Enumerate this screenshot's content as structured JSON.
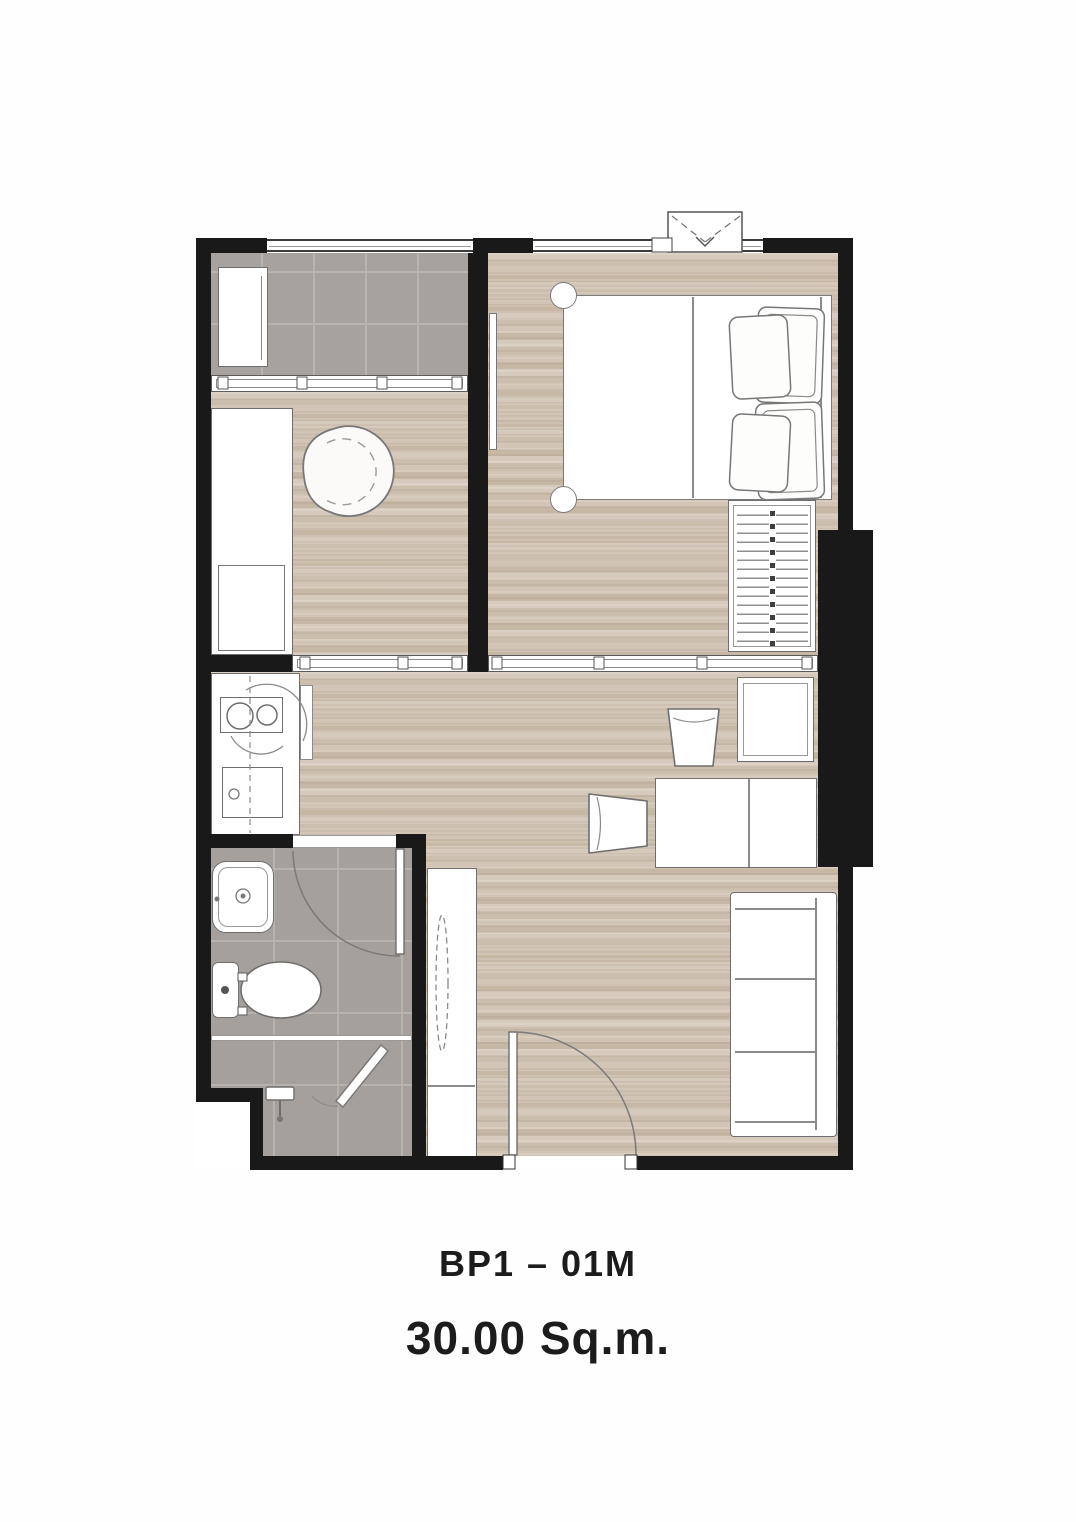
{
  "caption": {
    "unit_label": "BP1 – 01M",
    "area_label": "30.00 Sq.m."
  },
  "colors": {
    "wall": "#191919",
    "wood_floor": "#cfc1b0",
    "tile_floor": "#a7a29d",
    "tile_grid": "#b8b4af",
    "outline": "#6e6e6e",
    "background": "#ffffff",
    "text": "#1c1c1c"
  },
  "rooms": [
    "balcony",
    "multipurpose-room",
    "bedroom",
    "kitchen",
    "living-dining",
    "bathroom",
    "shower",
    "entry"
  ],
  "furniture_icons": [
    "ac-unit-icon",
    "counter-icon",
    "washing-machine-icon",
    "lounge-chair-icon",
    "mirror-icon",
    "double-bed-icon",
    "pillow-icon",
    "wardrobe-hangers-icon",
    "two-burner-stove-icon",
    "kitchen-sink-icon",
    "dining-table-icon",
    "dining-chair-icon",
    "wall-cabinet-icon",
    "sofa-icon",
    "entry-cabinet-icon",
    "tall-mirror-icon",
    "bathroom-sink-icon",
    "toilet-icon",
    "shower-head-icon",
    "shower-screen-icon",
    "swing-door-icon",
    "sliding-door-icon",
    "window-icon",
    "railing-icon",
    "condenser-unit-icon"
  ]
}
